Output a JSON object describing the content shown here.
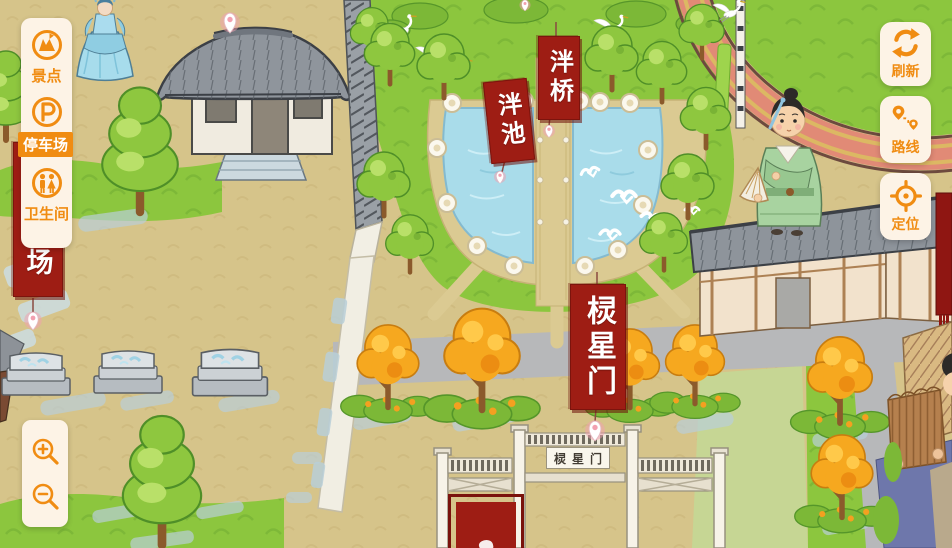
{
  "ui": {
    "left_panel": {
      "items": [
        {
          "id": "scenic",
          "label": "景点",
          "active": false
        },
        {
          "id": "parking",
          "label": "停车场",
          "active": true
        },
        {
          "id": "restroom",
          "label": "卫生间",
          "active": false
        }
      ]
    },
    "right_buttons": [
      {
        "id": "refresh",
        "label": "刷新"
      },
      {
        "id": "route",
        "label": "路线"
      },
      {
        "id": "locate",
        "label": "定位"
      }
    ],
    "zoom_controls": {
      "zoom_in": "+",
      "zoom_out": "-"
    }
  },
  "map": {
    "labels": {
      "bridge": "泮桥",
      "pond": "泮池",
      "lingxing_gate": "棂星门",
      "left_partial": "场"
    },
    "gate_plaque": "棂星门"
  },
  "colors": {
    "accent_orange": "#f08c12",
    "panel_cream": "#fdf3e6",
    "banner_red": "#9e1d14",
    "banner_text": "#ffffff",
    "water_blue": "#a9dcea",
    "grass_green": "#8cc63e",
    "ground_tan": "#d6c48a"
  }
}
